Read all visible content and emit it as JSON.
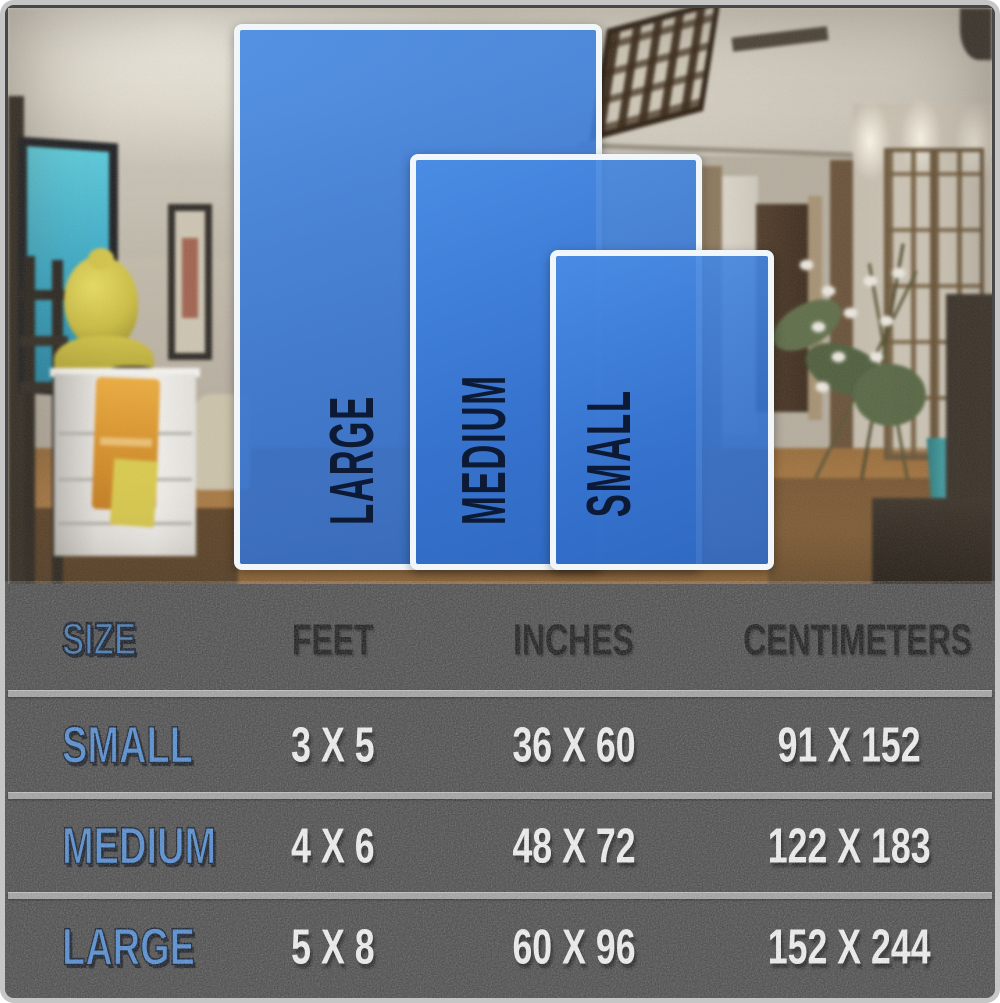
{
  "colors": {
    "rug_fill_blue": "#3d7cd7",
    "rug_border_white": "#f0f6fa",
    "rug_label_navy": "#0c1a36",
    "table_background_gray": "#4f4f4f",
    "table_separator_gray": "#a2a2a2",
    "table_accent_blue": "#4e8bd4",
    "table_value_white": "#f4f4f4",
    "table_header_black": "#121212"
  },
  "size_preview": {
    "rugs": [
      {
        "id": "large",
        "label": "LARGE"
      },
      {
        "id": "medium",
        "label": "MEDIUM"
      },
      {
        "id": "small",
        "label": "SMALL"
      }
    ]
  },
  "size_table": {
    "headers": {
      "size": "SIZE",
      "feet": "FEET",
      "inches": "INCHES",
      "centimeters": "CENTIMETERS"
    },
    "rows": [
      {
        "size": "SMALL",
        "feet": "3 X 5",
        "inches": "36 X 60",
        "centimeters": "91 X 152"
      },
      {
        "size": "MEDIUM",
        "feet": "4 X 6",
        "inches": "48 X 72",
        "centimeters": "122 X 183"
      },
      {
        "size": "LARGE",
        "feet": "5 X 8",
        "inches": "60 X 96",
        "centimeters": "152 X 244"
      }
    ]
  },
  "chart_data": {
    "type": "table",
    "columns": [
      "SIZE",
      "FEET",
      "INCHES",
      "CENTIMETERS"
    ],
    "rows": [
      [
        "SMALL",
        "3 X 5",
        "36 X 60",
        "91 X 152"
      ],
      [
        "MEDIUM",
        "4 X 6",
        "48 X 72",
        "122 X 183"
      ],
      [
        "LARGE",
        "5 X 8",
        "60 X 96",
        "152 X 244"
      ]
    ]
  }
}
